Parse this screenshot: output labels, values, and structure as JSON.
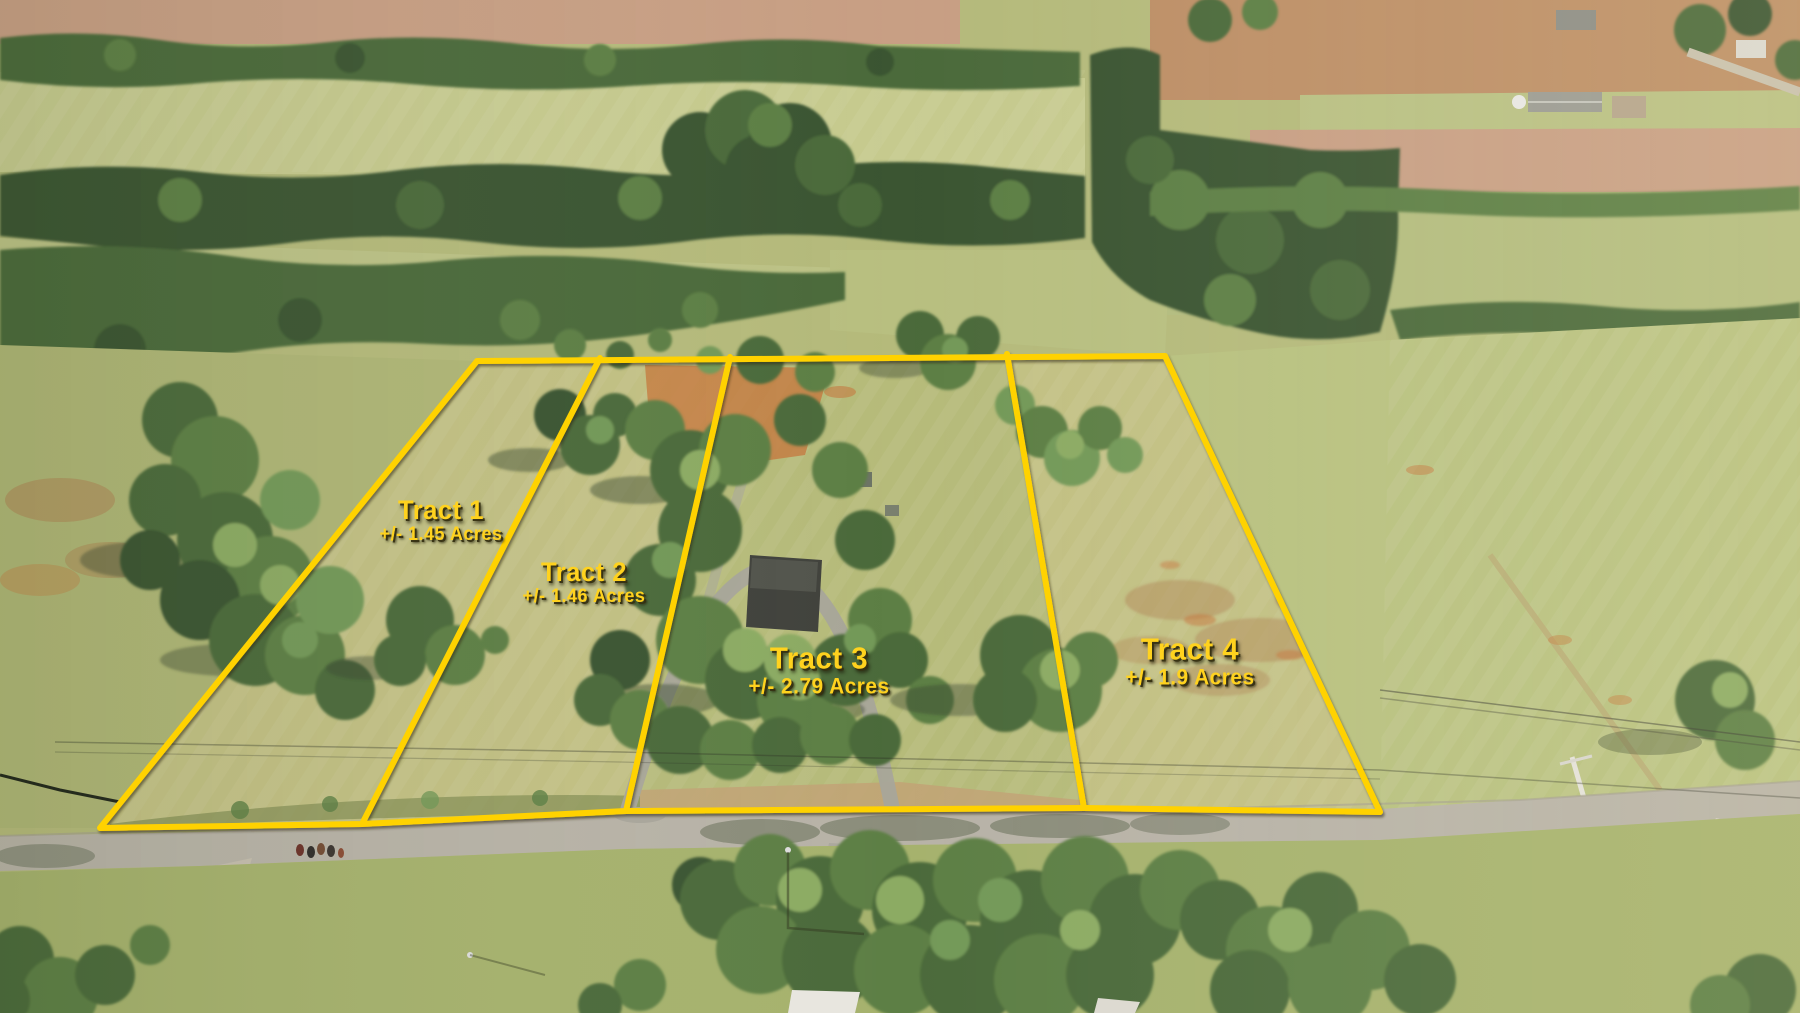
{
  "photo": {
    "type": "aerial-drone-view",
    "subject": "Rural acreage divided into four surveyed tracts outlined in yellow, bordered by a country road",
    "boundary_color": "#FFD200",
    "label_color": "#FFD21E"
  },
  "tracts": [
    {
      "id": "tract-1",
      "name": "Tract 1",
      "acreage": "+/- 1.45 Acres"
    },
    {
      "id": "tract-2",
      "name": "Tract 2",
      "acreage": "+/- 1.46 Acres"
    },
    {
      "id": "tract-3",
      "name": "Tract 3",
      "acreage": "+/- 2.79 Acres"
    },
    {
      "id": "tract-4",
      "name": "Tract 4",
      "acreage": "+/- 1.9 Acres"
    }
  ]
}
